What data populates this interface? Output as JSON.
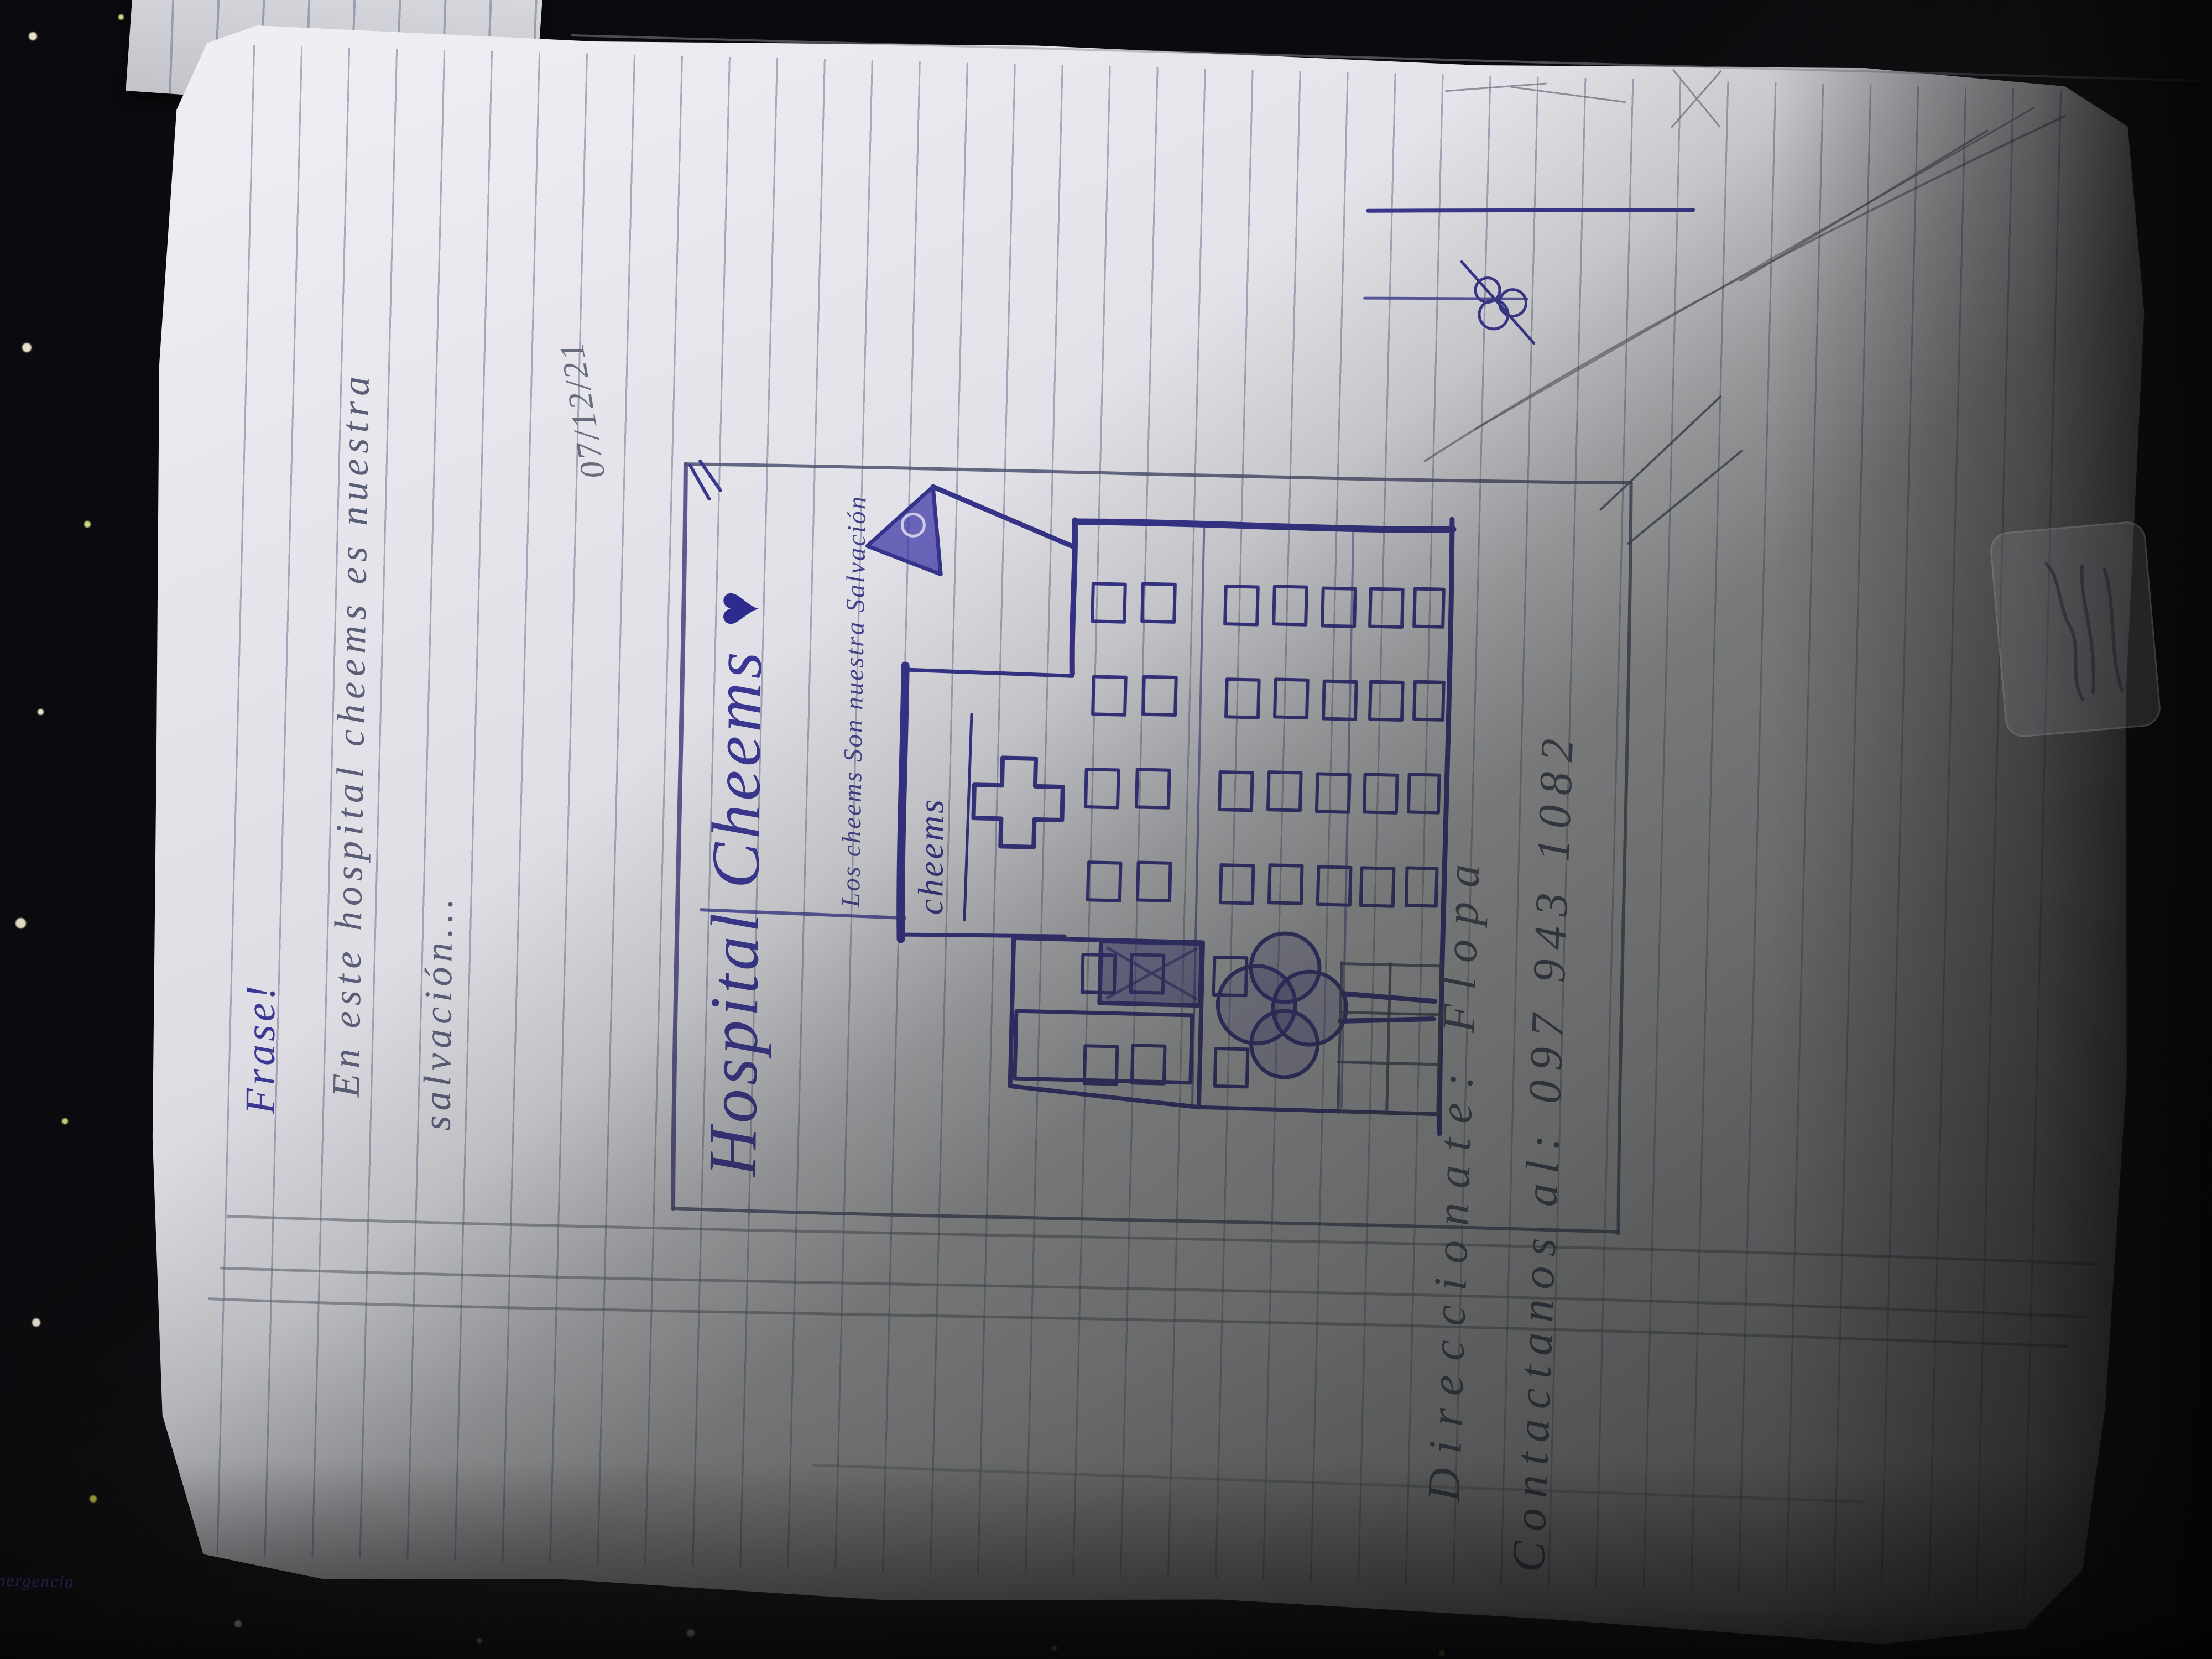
{
  "colors": {
    "ink": "#3b3794",
    "pencil": "#5a5e75",
    "paper": "#e7e6ec",
    "heart": "#2e2b8e",
    "background": "#0b0a0e"
  },
  "notebook": {
    "heading": "Frase!",
    "phrase_line_1": "En este hospital cheems es nuestra",
    "phrase_line_2": "salvación...",
    "date": "07/12/21",
    "poster": {
      "title": "Hospital Cheems",
      "heart": "♥",
      "subtitle": "Los cheems Son nuestra Salvación",
      "building_sign": "cheems",
      "emergency_sign": "Emergencia",
      "address_line": "Direccionate: Flopa",
      "contact_line": "Contactanos al: 097 943 1082"
    }
  }
}
